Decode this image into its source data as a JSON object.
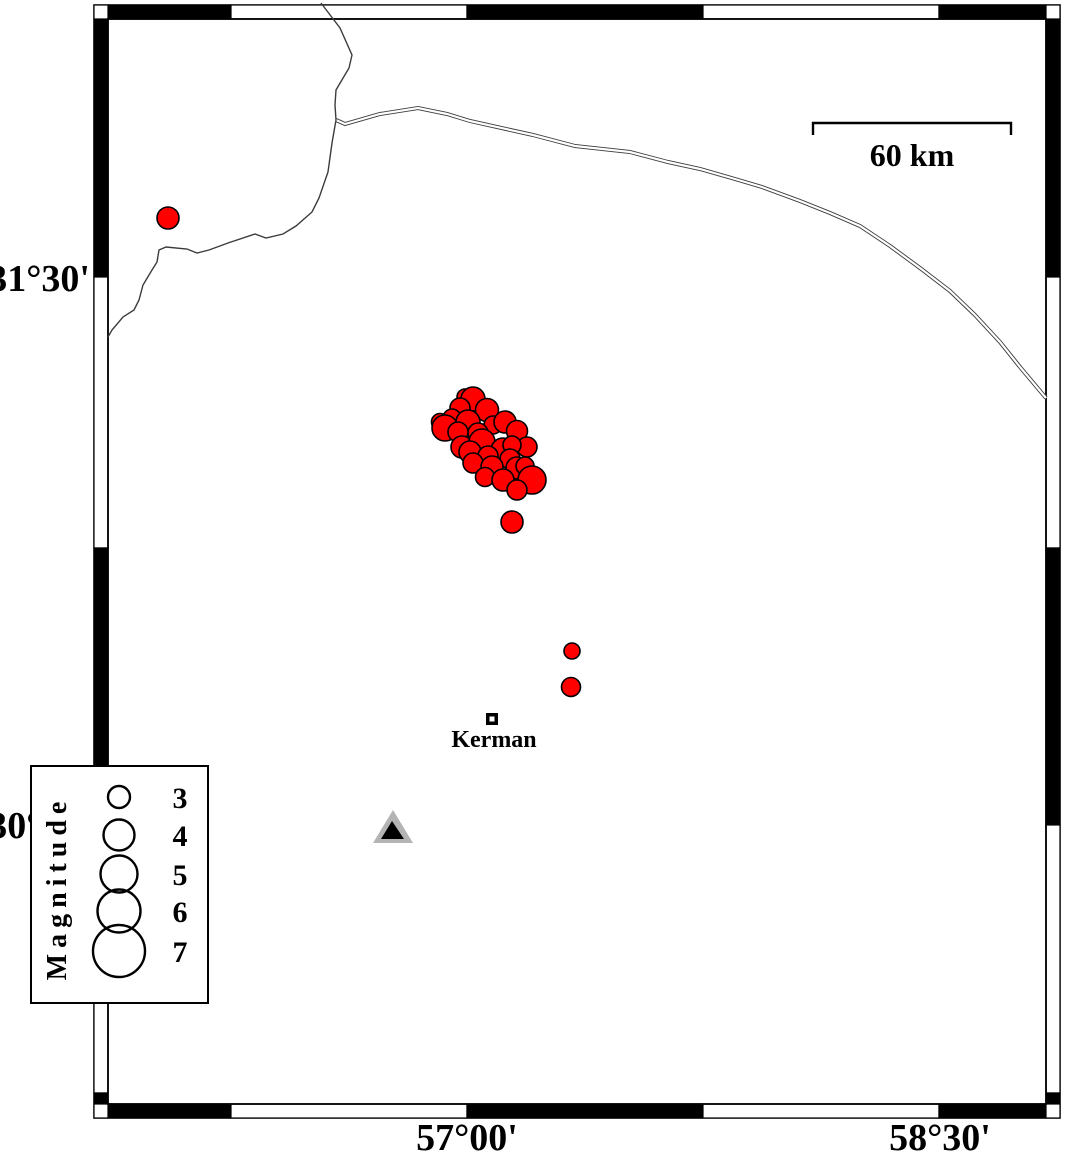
{
  "figure": {
    "type": "seismicity-map",
    "region_labels": [
      "31°30'",
      "30°00'",
      "57°00'",
      "58°30'"
    ]
  },
  "colors": {
    "earthquake_fill": "#ff0000",
    "marker_stroke": "#000000",
    "station_outer": "#b4b4b4",
    "station_inner": "#000000",
    "road": "#3c3c3c",
    "frame_black": "#000000",
    "frame_white": "#ffffff"
  },
  "frame": {
    "inner": {
      "x": 108,
      "y": 19,
      "right": 1046,
      "bottom": 1104
    },
    "band": 14,
    "x_bounds": [
      108,
      231,
      467,
      703,
      939,
      1046
    ],
    "y_bounds": [
      19,
      277,
      548,
      825,
      1093,
      1104
    ]
  },
  "axes": {
    "left": [
      {
        "text": "31°30'",
        "x": 90,
        "y": 291,
        "anchor": "end"
      },
      {
        "text": "30°00'",
        "x": 90,
        "y": 838,
        "anchor": "end"
      }
    ],
    "bottom": [
      {
        "text": "57°00'",
        "x": 467,
        "y": 1150,
        "anchor": "middle"
      },
      {
        "text": "58°30'",
        "x": 940,
        "y": 1150,
        "anchor": "middle"
      }
    ]
  },
  "scalebar": {
    "label": "60 km",
    "x1": 813,
    "x2": 1011,
    "y": 123,
    "tick_drop": 12,
    "label_x": 912,
    "label_y": 166
  },
  "city": {
    "name": "Kerman",
    "x": 492,
    "y": 719,
    "square_outer": 12,
    "square_inner": 5,
    "label_x": 494,
    "label_y": 747
  },
  "station": {
    "outer_points": "373,843 413,843 393,810",
    "inner_points": "381,839 404,839 392,821"
  },
  "legend": {
    "title": "Magnitude",
    "box": {
      "x": 31,
      "y": 766,
      "w": 177,
      "h": 237
    },
    "title_x": 66,
    "title_y": 888,
    "circle_cx": 119,
    "label_x": 180,
    "entries": [
      {
        "label": "3",
        "cy": 797,
        "r": 11
      },
      {
        "label": "4",
        "cy": 835,
        "r": 15.5
      },
      {
        "label": "5",
        "cy": 874,
        "r": 18.5
      },
      {
        "label": "6",
        "cy": 911,
        "r": 21.5
      },
      {
        "label": "7",
        "cy": 951,
        "r": 26
      }
    ]
  },
  "roads": {
    "single": [
      "321,3 340,28 352,55 349,68 336,90 335,105 336,120 332,143 328,172 319,198 312,212 296,226 283,234 266,238 255,234 228,243 209,250 197,253 187,249 166,247 159,250 157,262 152,270 143,285 139,300 134,310 123,317 112,330 108,337"
    ],
    "double": [
      "336,120 345,124 380,114 418,108 447,114 470,121 533,135 575,146 630,152 668,162 700,169 735,179 762,187 800,201 830,213 860,226 890,246 920,268 950,291 975,315 1000,342 1020,367 1046,398"
    ]
  },
  "earthquakes": [
    [
      465,
      397,
      8
    ],
    [
      473,
      399,
      12
    ],
    [
      460,
      408,
      10
    ],
    [
      487,
      410,
      11.5
    ],
    [
      452,
      418,
      9
    ],
    [
      440,
      422,
      8.5
    ],
    [
      445,
      428,
      13
    ],
    [
      468,
      422,
      12
    ],
    [
      493,
      425,
      9
    ],
    [
      505,
      422,
      11
    ],
    [
      517,
      431,
      10.5
    ],
    [
      478,
      433,
      10
    ],
    [
      458,
      432,
      10
    ],
    [
      462,
      447,
      11
    ],
    [
      482,
      442,
      13
    ],
    [
      503,
      450,
      12
    ],
    [
      527,
      447,
      10
    ],
    [
      512,
      445,
      9
    ],
    [
      470,
      452,
      11
    ],
    [
      488,
      456,
      10
    ],
    [
      510,
      459,
      10
    ],
    [
      473,
      463,
      10
    ],
    [
      492,
      467,
      11
    ],
    [
      517,
      468,
      11
    ],
    [
      525,
      466,
      9
    ],
    [
      485,
      477,
      9.5
    ],
    [
      503,
      480,
      11
    ],
    [
      532,
      480,
      14
    ],
    [
      517,
      490,
      10
    ],
    [
      168,
      218,
      11
    ],
    [
      512,
      522,
      11
    ],
    [
      572,
      651,
      8
    ],
    [
      571,
      687,
      9.5
    ]
  ]
}
